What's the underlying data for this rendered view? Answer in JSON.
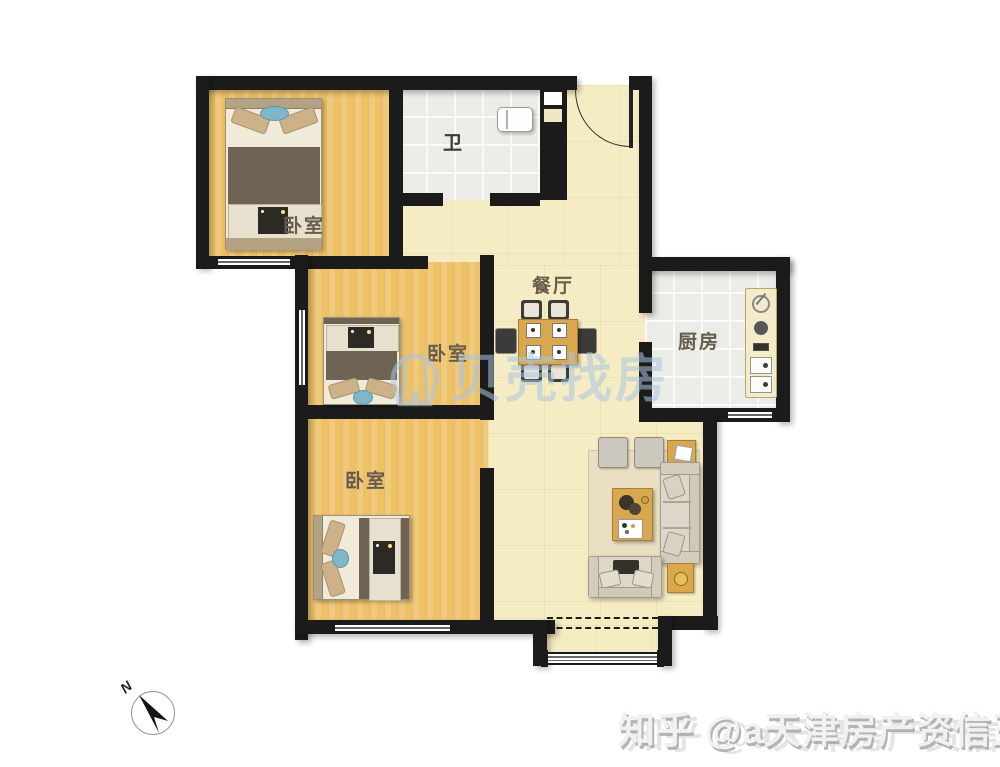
{
  "rooms": {
    "bedroom_top": {
      "label": "卧室"
    },
    "bedroom_mid": {
      "label": "卧室"
    },
    "bedroom_bottom": {
      "label": "卧室"
    },
    "bathroom": {
      "label": "卫"
    },
    "dining": {
      "label": "餐厅"
    },
    "kitchen": {
      "label": "厨房"
    }
  },
  "watermarks": {
    "center": {
      "text": "贝壳找房",
      "color": "#a9c6e2"
    },
    "bottom": {
      "text": "知乎 @a天津房产资信王",
      "color": "#f1f1f1"
    }
  },
  "compass": {
    "label": "N"
  },
  "colors": {
    "wall": "#1b1b1b",
    "wood_floor": "#eec167",
    "cream_floor": "#f6ecc3",
    "tile_floor": "#ebebe7",
    "wood_furniture": "#d9a84e",
    "watermark_blue": "#a9c6e2"
  }
}
